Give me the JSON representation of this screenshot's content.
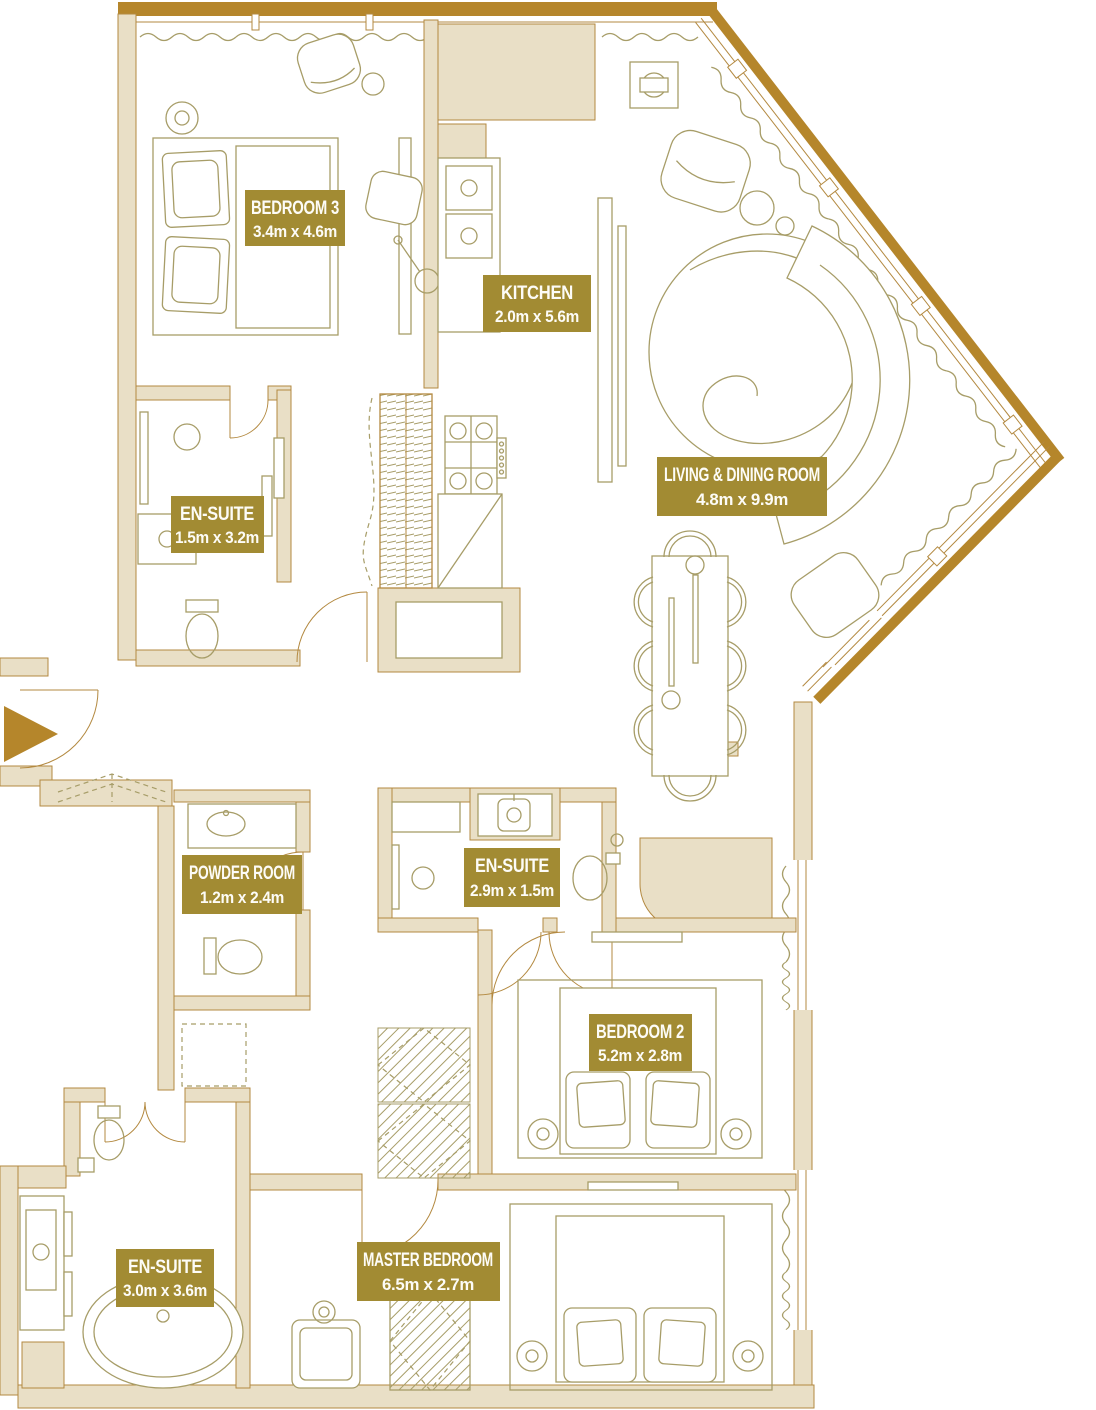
{
  "plan": {
    "colors": {
      "badge": "#a28b33",
      "badge_text": "#fdfcf7",
      "wall_fill": "#e9dfc6",
      "wall_stroke": "#b38940",
      "exterior": "#b5862b",
      "furniture": "#a79d68",
      "floor": "#ffffff"
    },
    "rooms": [
      {
        "id": "bedroom-3",
        "name": "BEDROOM 3",
        "dims": "3.4m x 4.6m"
      },
      {
        "id": "kitchen",
        "name": "KITCHEN",
        "dims": "2.0m x 5.6m"
      },
      {
        "id": "en-suite-bedroom-3",
        "name": "EN-SUITE",
        "dims": "1.5m x 3.2m"
      },
      {
        "id": "living-dining-room",
        "name": "LIVING & DINING ROOM",
        "dims": "4.8m x 9.9m"
      },
      {
        "id": "powder-room",
        "name": "POWDER ROOM",
        "dims": "1.2m x 2.4m"
      },
      {
        "id": "en-suite-bedroom-2",
        "name": "EN-SUITE",
        "dims": "2.9m x 1.5m"
      },
      {
        "id": "bedroom-2",
        "name": "BEDROOM 2",
        "dims": "5.2m x 2.8m"
      },
      {
        "id": "en-suite-master",
        "name": "EN-SUITE",
        "dims": "3.0m x 3.6m"
      },
      {
        "id": "master-bedroom",
        "name": "MASTER BEDROOM",
        "dims": "6.5m x 2.7m"
      }
    ],
    "entry": {
      "icon": "entry-arrow"
    }
  }
}
